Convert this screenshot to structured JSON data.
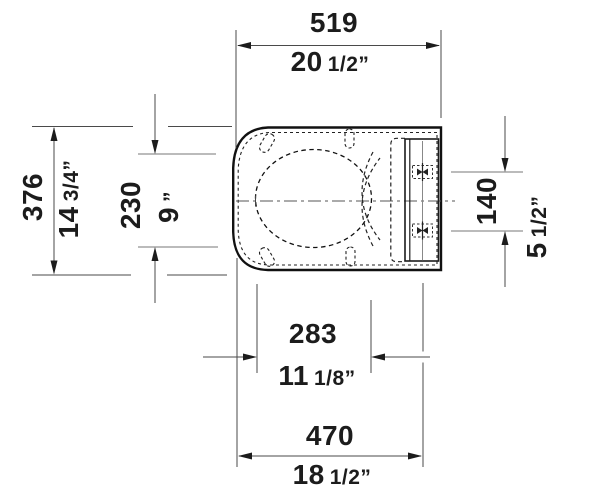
{
  "figure": {
    "type": "technical-drawing",
    "subject": "toilet-seat-top-view",
    "line_color": "#1c1c1c",
    "dim_line_color": "#4a4a4a",
    "background": "#ffffff"
  },
  "dimensions": {
    "length_overall": {
      "mm": "519",
      "inch_int": "20",
      "inch_frac": "1/2”"
    },
    "width_overall": {
      "mm": "376",
      "inch_int": "14",
      "inch_frac": "3/4”"
    },
    "opening_width": {
      "mm": "230",
      "inch_int": "9",
      "inch_frac": "”"
    },
    "hole_spacing": {
      "mm": "140",
      "inch_int": "5",
      "inch_frac": "1/2”"
    },
    "opening_length": {
      "mm": "283",
      "inch_int": "11",
      "inch_frac": "1/8”"
    },
    "front_to_holes": {
      "mm": "470",
      "inch_int": "18",
      "inch_frac": "1/2”"
    }
  }
}
